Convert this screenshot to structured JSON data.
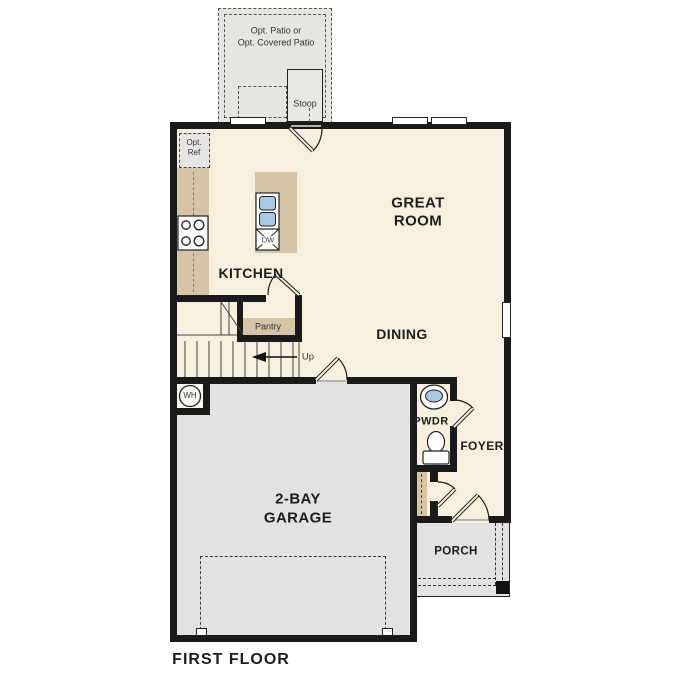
{
  "page": {
    "title": "FIRST FLOOR"
  },
  "colors": {
    "floor": "#f8f0df",
    "garage": "#e3e2e0",
    "patio": "#e6e5e2",
    "casework": "#d5c5a6",
    "wall": "#1a1a1a",
    "blue": "#aac7e4",
    "text": "#1d1d1d"
  },
  "areas": {
    "patio": {
      "label_line1": "Opt. Patio or",
      "label_line2": "Opt. Covered Patio"
    },
    "stoop": {
      "label": "Stoop"
    },
    "kitchen": {
      "label": "KITCHEN",
      "opt_ref_line1": "Opt.",
      "opt_ref_line2": "Ref",
      "dishwasher": "DW"
    },
    "great_room": {
      "label_line1": "GREAT",
      "label_line2": "ROOM"
    },
    "dining": {
      "label": "DINING"
    },
    "pantry": {
      "label": "Pantry"
    },
    "stairs": {
      "label": "Up"
    },
    "garage": {
      "label_line1": "2-BAY",
      "label_line2": "GARAGE",
      "water_heater": "WH"
    },
    "powder": {
      "label": "PWDR"
    },
    "foyer": {
      "label": "FOYER"
    },
    "porch": {
      "label": "PORCH"
    }
  },
  "footer": {
    "label": "FIRST FLOOR"
  }
}
